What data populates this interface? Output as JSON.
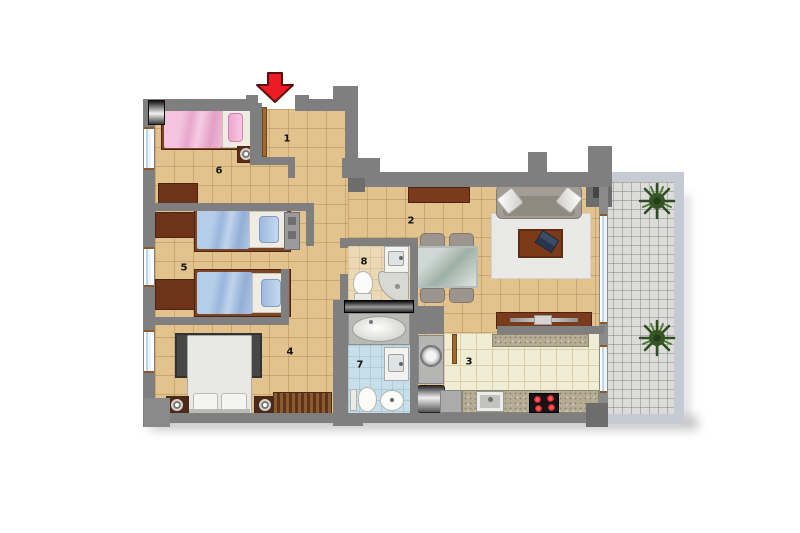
{
  "title": "apartment-floor-plan",
  "rooms": {
    "hall": {
      "number": "1"
    },
    "living_dining": {
      "number": "2"
    },
    "kitchen": {
      "number": "3"
    },
    "master_bedroom": {
      "number": "4"
    },
    "twin_bedroom": {
      "number": "5"
    },
    "bedroom": {
      "number": "6"
    },
    "bathroom": {
      "number": "7"
    },
    "ensuite_bathroom": {
      "number": "8"
    }
  },
  "colors": {
    "wall": "#7f7f7f",
    "wall_dark": "#6d6d6d",
    "floor_tan": "#e3c38d",
    "floor_kitchen": "#f1ecd4",
    "floor_bath_blue": "#c6dfe9",
    "floor_bath_beige": "#ead9b4",
    "terrace_tile": "#dcdcda",
    "terrace_wall": "#c6cad2",
    "entrance_arrow": "#ed1c24",
    "bed_pink": "#f2b9d6",
    "bed_blue": "#abc4e2",
    "furniture_brown": "#6e3419",
    "sofa_gray": "#a39d95",
    "rug_dark": "#474747",
    "rug_light": "#e9e9e7",
    "plant_green": "#3a5c28"
  }
}
